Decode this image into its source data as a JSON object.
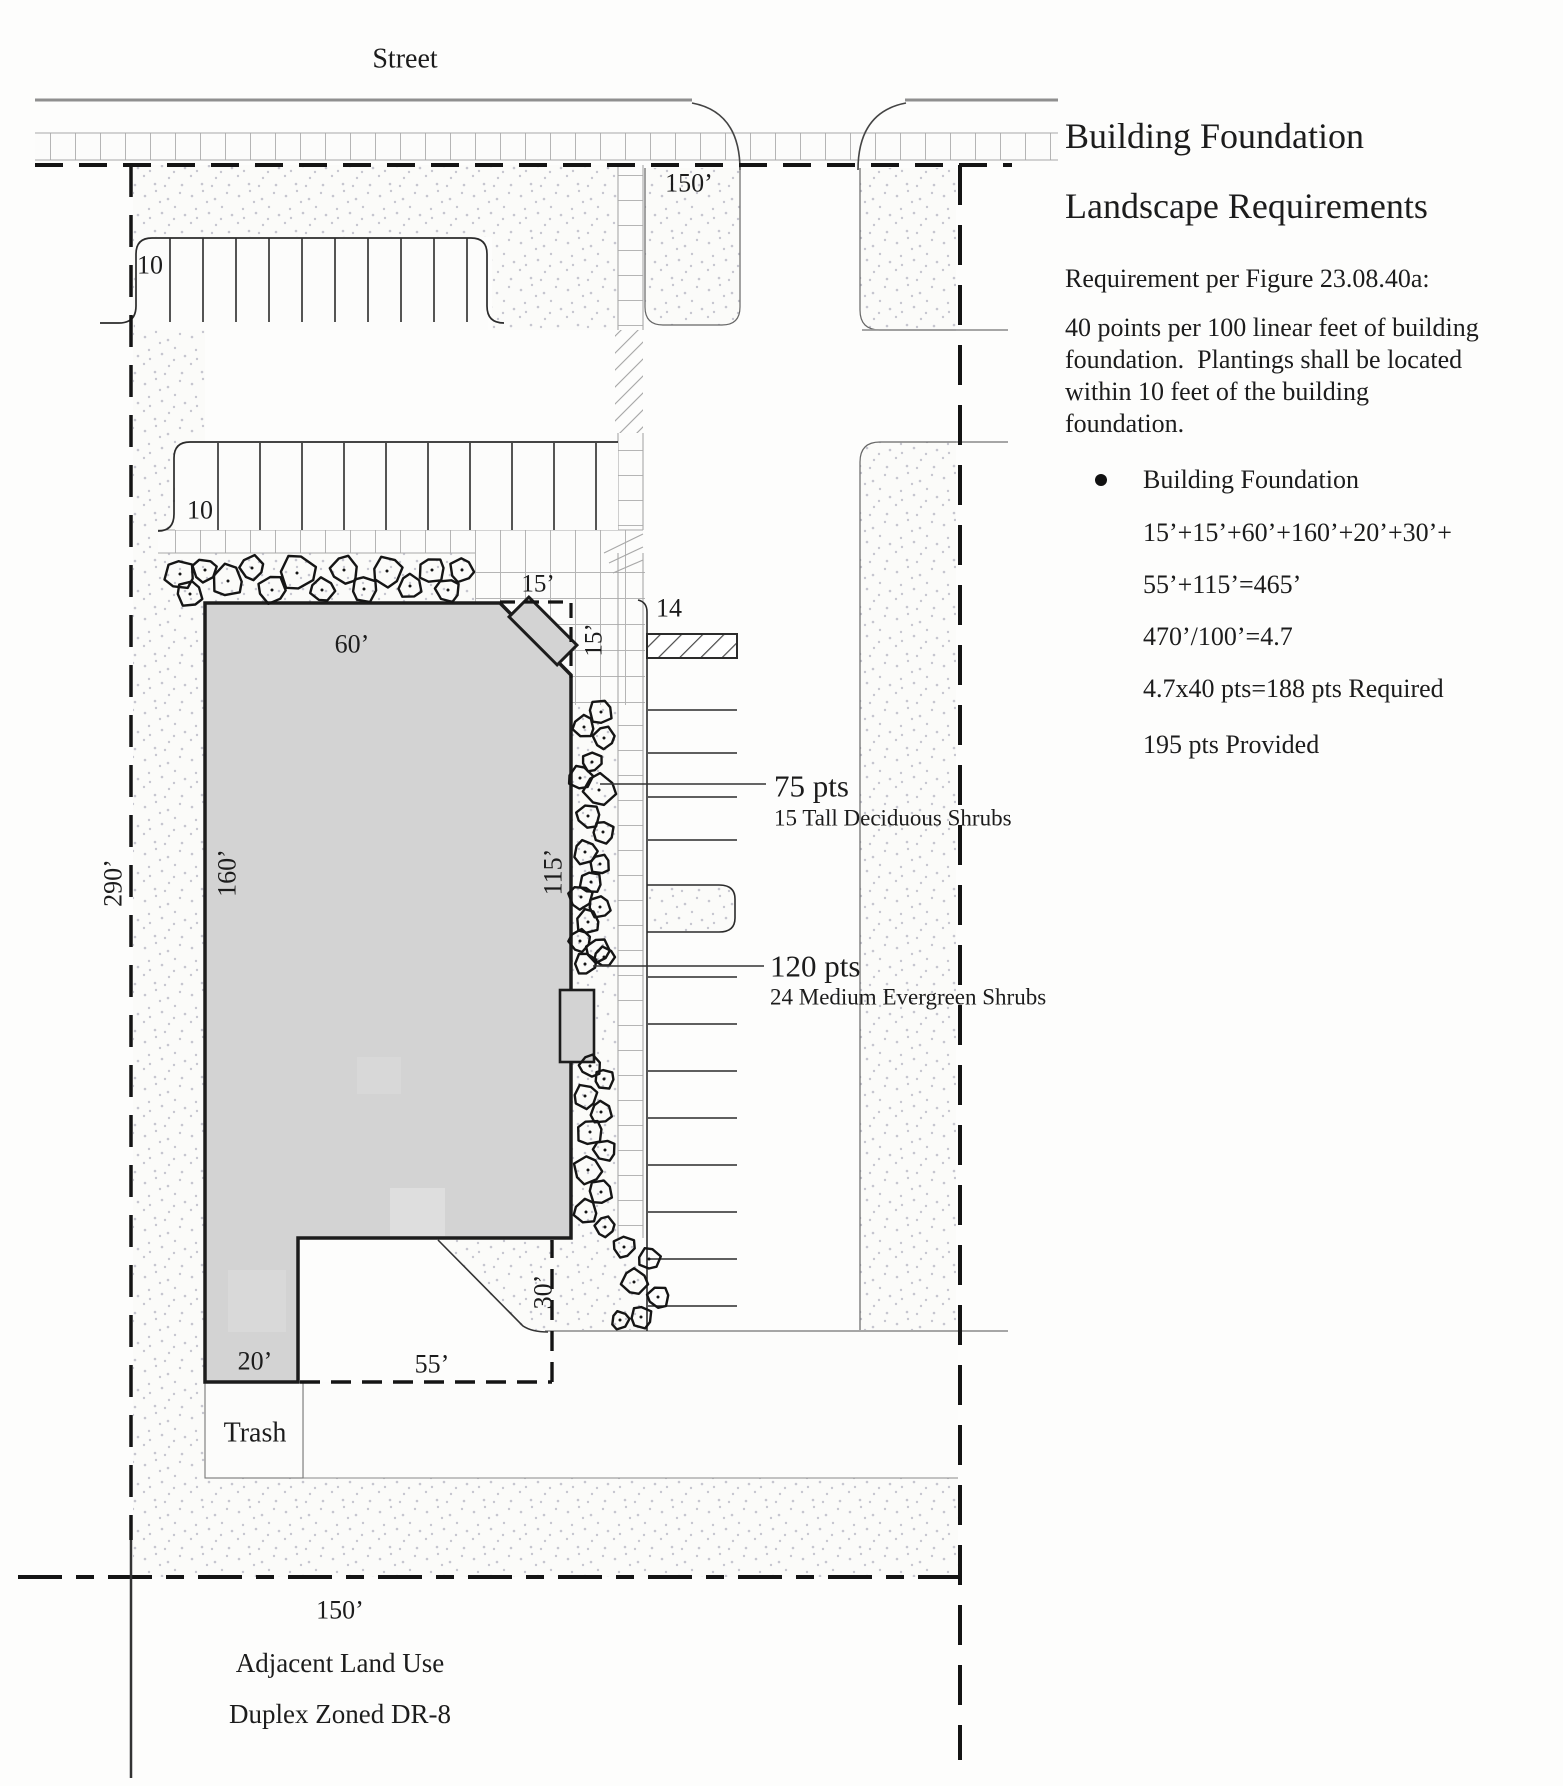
{
  "plan": {
    "street_label": "Street",
    "dim_top_frontage": "150’",
    "dim_bottom_frontage": "150’",
    "dim_left": "290’",
    "row1_count": "10",
    "row2_count": "10",
    "side_count": "14",
    "dim_chamfer_top": "15’",
    "dim_chamfer_side": "15’",
    "dim_building_top": "60’",
    "dim_building_right": "115’",
    "dim_building_left": "160’",
    "dim_leg": "20’",
    "dim_notch_bottom": "55’",
    "dim_notch_side": "30’",
    "trash_label": "Trash",
    "adjacent_line1": "Adjacent Land Use",
    "adjacent_line2": "Duplex Zoned DR-8",
    "callout1": {
      "points": "75 pts",
      "desc": "15 Tall Deciduous Shrubs"
    },
    "callout2": {
      "points": "120 pts",
      "desc": "24 Medium Evergreen Shrubs"
    }
  },
  "panel": {
    "title_line1": "Building Foundation",
    "title_line2": "Landscape Requirements",
    "subtitle": "Requirement per Figure 23.08.40a:",
    "body_line1": "40 points per 100 linear feet of building",
    "body_line2": "foundation.  Plantings shall be located",
    "body_line3": "within 10 feet of the building",
    "body_line4": "foundation.",
    "bullet_label": "Building Foundation",
    "calc_line1": "15’+15’+60’+160’+20’+30’+",
    "calc_line2": "55’+115’=465’",
    "calc_line3": "470’/100’=4.7",
    "calc_line4": "4.7x40 pts=188 pts Required",
    "calc_line5": "195 pts Provided"
  },
  "colors": {
    "building_fill": "#d3d3d3",
    "ink": "#1c1c1c",
    "street_gray": "#8f8f8f"
  }
}
